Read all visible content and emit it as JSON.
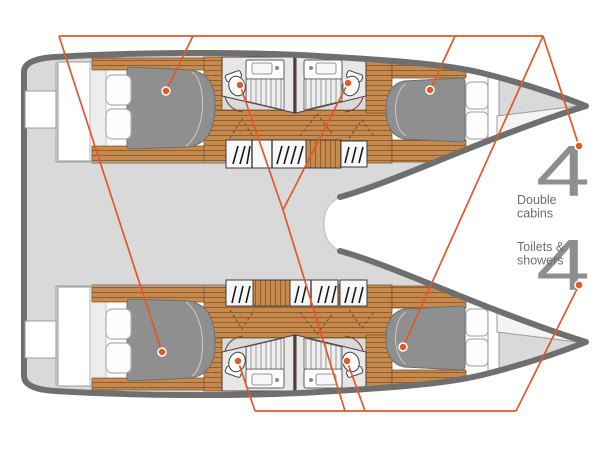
{
  "theme": {
    "accent": "#e2572b",
    "numeral": "#8e8e8e",
    "caption": "#6e6e6e",
    "hull": "#6f6f6f",
    "deck": "#d9d9d9",
    "mattress": "#8f8f8f",
    "wood": "#c68a4f"
  },
  "legend": {
    "double_cabins": {
      "count": "4",
      "line1": "Double",
      "line2": "cabins"
    },
    "toilets_showers": {
      "count": "4",
      "line1": "Toilets &",
      "line2": "showers"
    }
  },
  "markers": {
    "cabins": [
      {
        "x": 166,
        "y": 91
      },
      {
        "x": 430,
        "y": 90
      },
      {
        "x": 162,
        "y": 352
      },
      {
        "x": 403,
        "y": 347
      },
      {
        "x": 579,
        "y": 146
      }
    ],
    "toilets": [
      {
        "x": 240,
        "y": 85
      },
      {
        "x": 348,
        "y": 83
      },
      {
        "x": 238,
        "y": 361
      },
      {
        "x": 347,
        "y": 361
      },
      {
        "x": 579,
        "y": 285
      }
    ]
  }
}
